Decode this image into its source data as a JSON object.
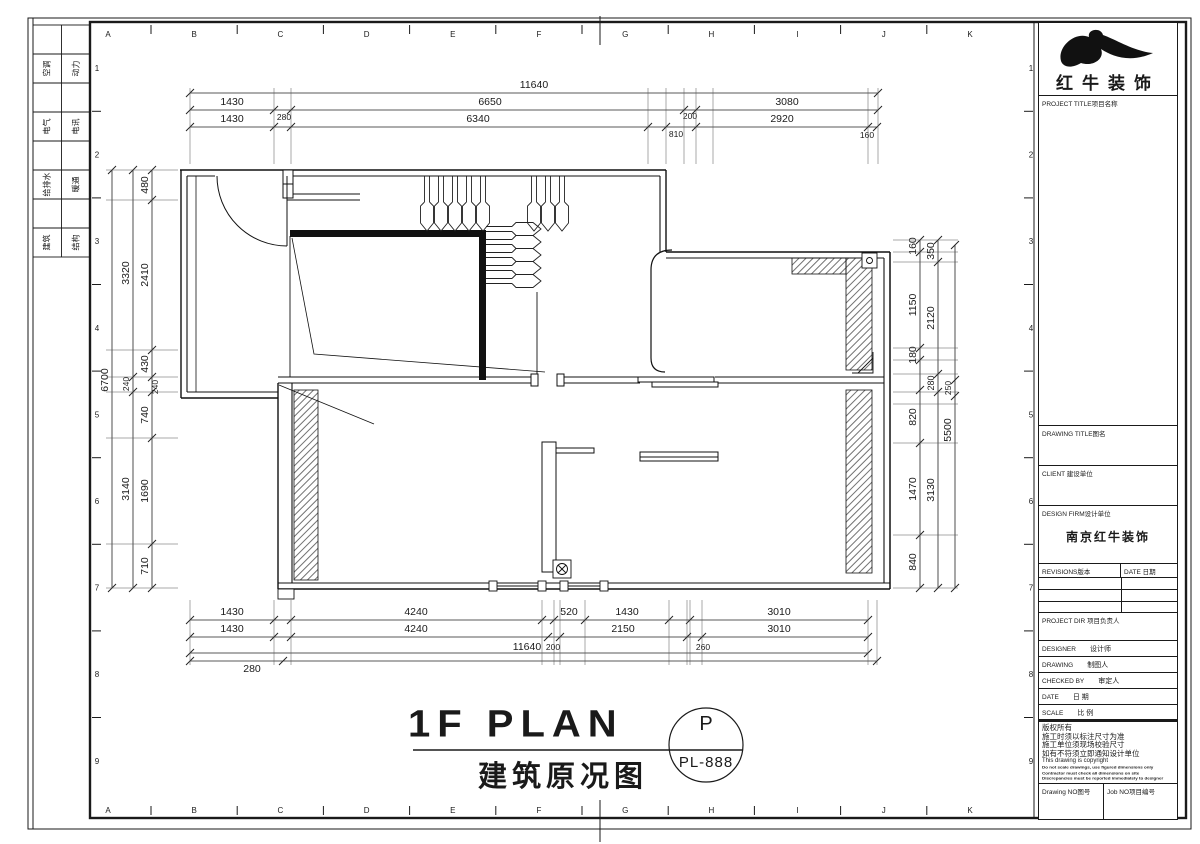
{
  "sheet": {
    "grid_letters": [
      "A",
      "B",
      "C",
      "D",
      "E",
      "F",
      "G",
      "H",
      "I",
      "J",
      "K"
    ],
    "grid_numbers": [
      "1",
      "2",
      "3",
      "4",
      "5",
      "6",
      "7",
      "8",
      "9"
    ]
  },
  "signature_strip": {
    "rows": [
      [
        "空调",
        "动力"
      ],
      [
        "电气",
        "电讯"
      ],
      [
        "给排水",
        "暖通"
      ],
      [
        "建筑",
        "结构"
      ]
    ]
  },
  "title_block": {
    "company": "红牛装饰",
    "project_label": "PROJECT TITLE项目名称",
    "drawing_title_label": "DRAWING TITLE图名",
    "client_label": "CLIENT 建设单位",
    "design_firm_label": "DESIGN FIRM设计单位",
    "design_firm_value": "南京红牛装饰",
    "revisions_label": "REVISIONS版本",
    "revision_date_label": "DATE 日期",
    "project_director_label": "PROJECT DIR 项目负责人",
    "designer_label": "DESIGNER",
    "designer_cn": "设计师",
    "drawing_by_label": "DRAWING",
    "drawing_by_cn": "制图人",
    "checked_by_label": "CHECKED BY",
    "checked_by_cn": "审定人",
    "date_label": "DATE",
    "date_cn": "日 期",
    "scale_label": "SCALE",
    "scale_cn": "比 例",
    "copyright_cn": [
      "版权所有",
      "施工时须以标注尺寸为准",
      "施工单位须现场校验尺寸",
      "如有不符须立即通知设计单位"
    ],
    "copyright_en": "This drawing is copyright",
    "copyright_notes": [
      "Do not scale drawings, use figured dimensions only",
      "Contractor must check all dimensions on site",
      "Discrepancies must be reported immediately to designer"
    ],
    "drawing_no_label": "Drawing NO图号",
    "job_no_label": "Job NO项目编号"
  },
  "plan_title": {
    "main": "1F PLAN",
    "sub": "建筑原况图",
    "stamp_top": "P",
    "stamp_no": "PL-888"
  },
  "dimensions": {
    "top_row1": [
      "11640"
    ],
    "top_row2": [
      "1430",
      "280",
      "6650",
      "200",
      "3080"
    ],
    "top_row3": [
      "1430",
      "6340",
      "810",
      "2920",
      "160"
    ],
    "bottom_row1": [
      "1430",
      "4240",
      "520",
      "1430",
      "3010"
    ],
    "bottom_row2": [
      "1430",
      "4240",
      "2150",
      "3010",
      "200",
      "260"
    ],
    "bottom_row3": [
      "11640"
    ],
    "bottom_row4": [
      "280"
    ],
    "left_outer": [
      "6700"
    ],
    "left_mid": [
      "3320",
      "240",
      "3140"
    ],
    "left_inner": [
      "480",
      "2410",
      "430",
      "240",
      "740",
      "1690",
      "710"
    ],
    "right_a": [
      "160",
      "1150",
      "180",
      "820",
      "1470",
      "840"
    ],
    "right_b": [
      "350",
      "2120",
      "280",
      "3130"
    ],
    "right_c": [
      "250",
      "5500"
    ]
  }
}
